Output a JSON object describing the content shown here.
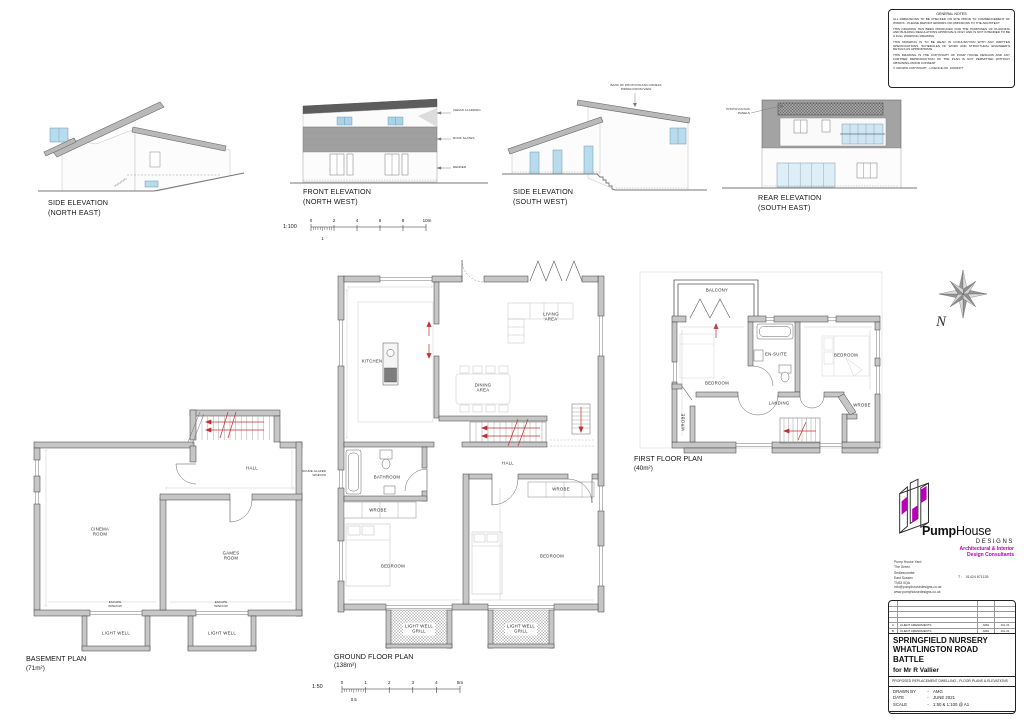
{
  "general_notes": {
    "title": "GENERAL NOTES",
    "paragraphs": [
      "ALL DIMENSIONS TO BE CHECKED ON SITE PRIOR TO COMMENCEMENT OF WORKS - PLEASE REPORT ERRORS OR OMISSIONS TO THE ARCHITECT",
      "THIS DRAWING HAS BEEN PRODUCED FOR THE PURPOSES OF PLANNING AND BUILDING REGULATIONS APPROVALS ONLY AND IS NOT INTENDED TO BE A FULL WORKING DRAWING",
      "THIS DRAWING IS TO BE READ IN CONJUNCTION WITH ANY WRITTEN SPECIFICATIONS, SCHEDULES OF WORK AND STRUCTURAL ENGINEER'S DETAILS AS APPROPRIATE",
      "THIS DRAWING IS THE COPYRIGHT OF PUMP HOUSE DESIGNS AND ANY FURTHER REPRODUCTION OF THE PLAN IS NOT PERMITTED WITHOUT OBTAINING PRIOR CONSENT",
      "© CROWN COPYRIGHT - LICENCE NO. 10003377"
    ]
  },
  "elevations": {
    "side_ne": {
      "title": "SIDE ELEVATION",
      "subtitle": "(NORTH EAST)"
    },
    "front_nw": {
      "title": "FRONT ELEVATION",
      "subtitle": "(NORTH WEST)",
      "annotations": [
        "CEDAR CLADDING",
        "ROOF SLATES",
        "RENDER"
      ]
    },
    "side_sw": {
      "title": "SIDE ELEVATION",
      "subtitle": "(SOUTH WEST)",
      "annotation": "BANK OF PHOTOVOLTAIC PANELS HIDDEN FROM VIEW"
    },
    "rear_se": {
      "title": "REAR ELEVATION",
      "subtitle": "(SOUTH EAST)",
      "annotation": "PHOTOVOLTAIC PANELS"
    }
  },
  "scale_bars": {
    "s100": {
      "ratio": "1:100",
      "ticks": [
        "0",
        "2",
        "4",
        "6",
        "8",
        "10m"
      ],
      "half": "1"
    },
    "s50": {
      "ratio": "1:50",
      "ticks": [
        "0",
        "1",
        "2",
        "3",
        "4",
        "5m"
      ],
      "half": "0.5"
    }
  },
  "plans": {
    "ground": {
      "title": "GROUND FLOOR PLAN",
      "area": "(138m²)",
      "rooms": {
        "kitchen": "KITCHEN",
        "living": "LIVING AREA",
        "dining": "DINING AREA",
        "bathroom": "BATHROOM",
        "hall": "HALL",
        "wrobe_left": "WROBE",
        "wrobe_right": "WROBE",
        "bedroom_left": "BEDROOM",
        "bedroom_right": "BEDROOM",
        "lightwell_left": "LIGHT WELL GRILL",
        "lightwell_right": "LIGHT WELL GRILL",
        "obscure_window": "OBSCURE GLAZED WINDOW"
      }
    },
    "first": {
      "title": "FIRST FLOOR PLAN",
      "area": "(40m²)",
      "rooms": {
        "balcony": "BALCONY",
        "bedroom_left": "BEDROOM",
        "bedroom_right": "BEDROOM",
        "ensuite": "EN-SUITE",
        "landing": "LANDING",
        "wrobe_left": "WROBE",
        "wrobe_right": "WROBE"
      }
    },
    "basement": {
      "title": "BASEMENT PLAN",
      "area": "(71m²)",
      "rooms": {
        "hall": "HALL",
        "cinema": "CINEMA ROOM",
        "games": "GAMES ROOM",
        "lightwell_left": "LIGHT WELL",
        "lightwell_right": "LIGHT WELL",
        "escape_left": "ESCAPE WINDOW",
        "escape_right": "ESCAPE WINDOW"
      }
    }
  },
  "compass": {
    "label": "N"
  },
  "branding": {
    "name_bold": "Pump",
    "name_light": "House",
    "designs": "DESIGNS",
    "tagline_line1": "Architectural & Interior",
    "tagline_line2": "Design Consultants",
    "address": [
      "Pump House Yard",
      "The Green",
      "Sedlescombe",
      "East Sussex",
      "TN33 0QA"
    ],
    "phone_label": "T :",
    "phone": "01424 871135",
    "email": "info@pumphousedesigns.co.uk",
    "website": "www.pumphousedesigns.co.uk",
    "accent_color": "#b800b8"
  },
  "title_block": {
    "revisions": [
      {
        "rev": "A",
        "desc": "CLIENT AMENDMENTS",
        "by": "AMG",
        "date": "JUL 21"
      },
      {
        "rev": "B",
        "desc": "CLIENT AMENDMENTS",
        "by": "AMG",
        "date": "JUL 21"
      }
    ],
    "project_line1": "SPRINGFIELD NURSERY",
    "project_line2": "WHATLINGTON ROAD",
    "project_line3": "BATTLE",
    "client": "for Mr R Vallier",
    "subtitle": "PROPOSED REPLACEMENT DWELLING - FLOOR PLANS & ELEVATIONS",
    "sep": "-",
    "drawn_by_label": "DRAWN BY",
    "drawn_by": "AMG",
    "date_label": "DATE",
    "date": "JUNE 2021",
    "scale_label": "SCALE",
    "scale": "1:50 & 1:100 @ A1",
    "drawing_no_label": "DRAWING No.",
    "drawing_no": "6940 / 1 / B"
  }
}
